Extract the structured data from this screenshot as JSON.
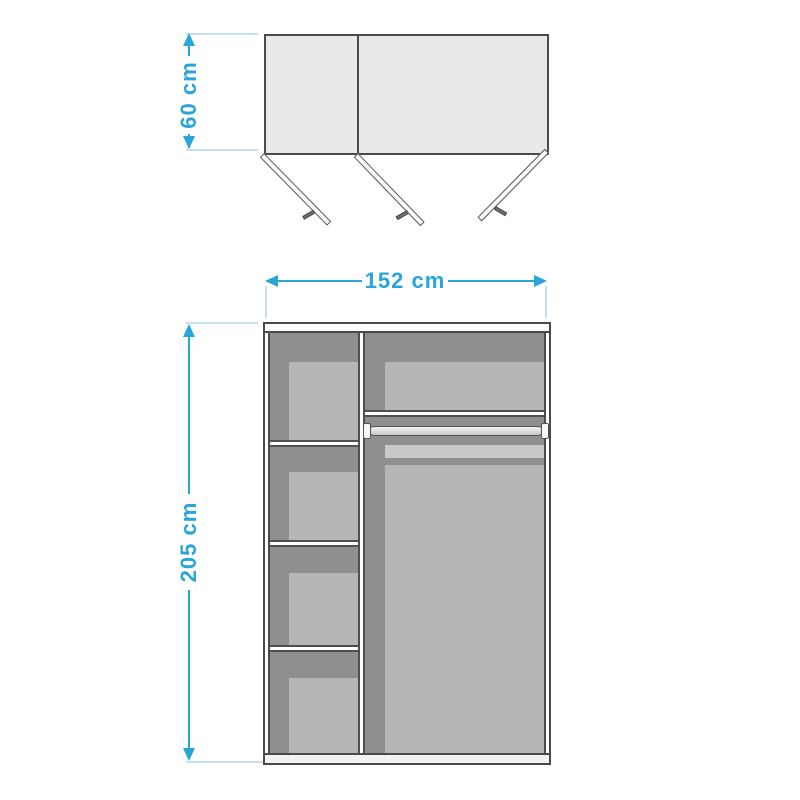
{
  "diagram": {
    "type": "wardrobe-dimension-diagram",
    "views": {
      "top_view": "wardrobe top view with three open doors",
      "front_view": "wardrobe front view with shelves and hanging rail"
    },
    "labels": {
      "depth": "60 cm",
      "width": "152 cm",
      "height": "205 cm"
    },
    "colors": {
      "dimension_blue": "#29A5D7",
      "extension_line_blue": "#C3E1EF",
      "outline_dark": "#4A4A4A",
      "door_fill": "#E9E9E9",
      "interior_dark": "#8F8F8F",
      "interior_light": "#B6B6B6",
      "band_light": "#C9C9C9",
      "panel_white": "#FDFDFD",
      "plinth_gray": "#F3F3F3",
      "handle_gray": "#6E6E6E"
    }
  }
}
